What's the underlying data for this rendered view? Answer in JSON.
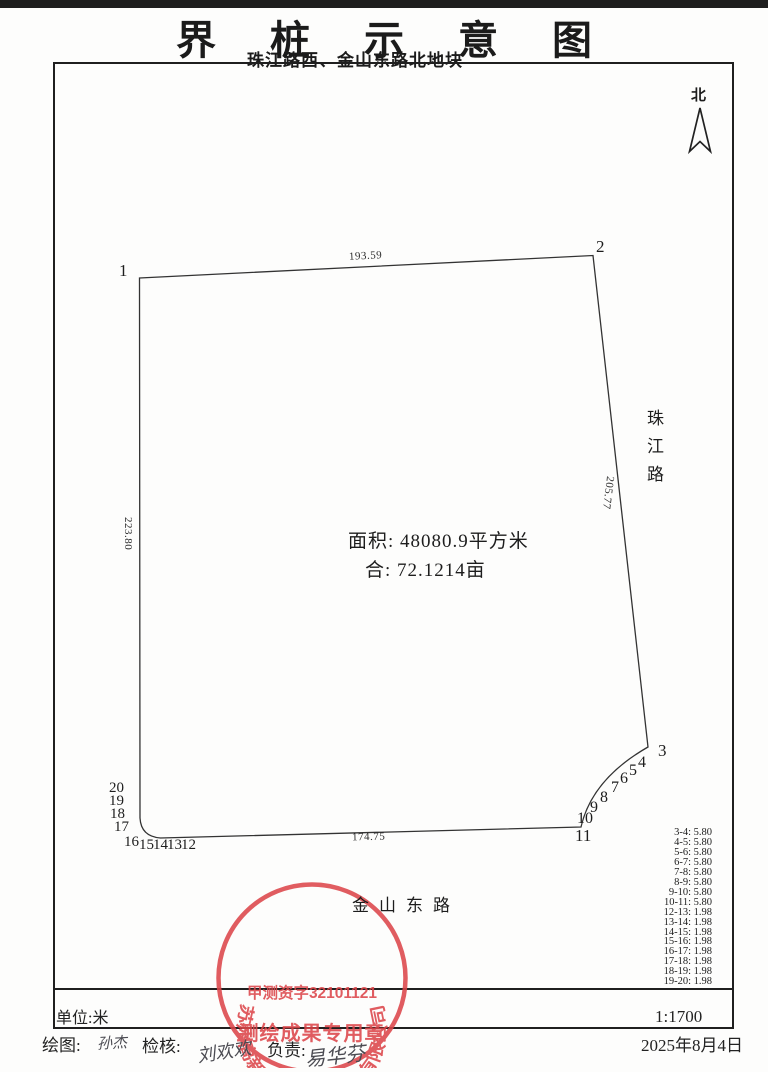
{
  "page": {
    "title": "界桩示意图",
    "subtitle": "珠江路西、金山东路北地块"
  },
  "north": {
    "label": "北"
  },
  "plot": {
    "area_line1": "面积: 48080.9平方米",
    "area_line2": "合: 72.1214亩",
    "edge_lengths": {
      "top": "193.59",
      "right": "205.77",
      "left": "223.80",
      "bottom": "174.75"
    },
    "vertices": [
      "1",
      "2",
      "3",
      "4",
      "5",
      "6",
      "7",
      "8",
      "9",
      "10",
      "11",
      "12",
      "13",
      "14",
      "15",
      "16",
      "17",
      "18",
      "19",
      "20"
    ]
  },
  "roads": {
    "right": "珠江路",
    "bottom": "金山东路"
  },
  "distances": [
    "3-4: 5.80",
    "4-5: 5.80",
    "5-6: 5.80",
    "6-7: 5.80",
    "7-8: 5.80",
    "8-9: 5.80",
    "9-10: 5.80",
    "10-11: 5.80",
    "12-13: 1.98",
    "13-14: 1.98",
    "14-15: 1.98",
    "15-16: 1.98",
    "16-17: 1.98",
    "17-18: 1.98",
    "18-19: 1.98",
    "19-20: 1.98"
  ],
  "stamp": {
    "ring_text": "苏州高新区测绘事务所有限公司",
    "license": "甲测资字32101121",
    "type_text": "测绘成果专用章",
    "color": "#dc4549"
  },
  "footer": {
    "unit": "单位:米",
    "scale": "1:1700",
    "drawn_label": "绘图:",
    "drawn_by": "孙杰",
    "check_label": "检核:",
    "checked_by": "刘欢欢",
    "charge_label": "负责:",
    "charge_by": "易华芬",
    "date": "2025年8月4日"
  }
}
